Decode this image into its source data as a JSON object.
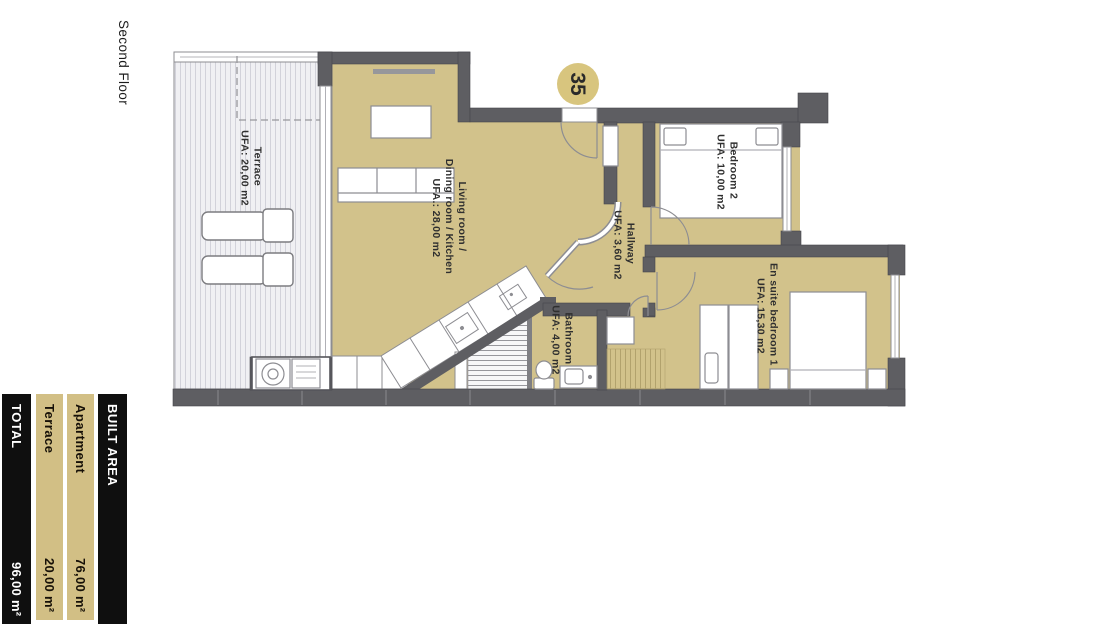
{
  "header": {
    "floor_label": "Second Floor",
    "unit_number": "35"
  },
  "plan": {
    "rooms": [
      {
        "id": "terrace",
        "name": "Terrace",
        "area": "UFA: 20,00 m2"
      },
      {
        "id": "living",
        "name": "Living room / Dining room / Kitchen",
        "name_lines": [
          "Living room /",
          "Dining room / Kitchen"
        ],
        "area": "UFA.: 28,00 m2"
      },
      {
        "id": "hallway",
        "name": "Hallway",
        "area": "UFA: 3,60 m2"
      },
      {
        "id": "bedroom2",
        "name": "Bedroom 2",
        "area": "UFA: 10,00 m2"
      },
      {
        "id": "ensuite",
        "name": "En suite bedroom 1",
        "area": "UFA: 15,30 m2"
      },
      {
        "id": "bathroom",
        "name": "Bathroom",
        "area": "UFA: 4,00 m2"
      }
    ]
  },
  "legend": {
    "built_area_label": "BUILT AREA",
    "rows": [
      {
        "label": "Apartment",
        "value": "76,00 m²"
      },
      {
        "label": "Terrace",
        "value": "20,00 m²"
      }
    ],
    "total_label": "TOTAL",
    "total_value": "96,00 m²"
  },
  "colors": {
    "room_fill": "#d2c28b",
    "wall": "#5e5e62",
    "legend_black": "#0f0f0f",
    "legend_tan": "#d2bf85",
    "badge": "#d8c57e"
  }
}
